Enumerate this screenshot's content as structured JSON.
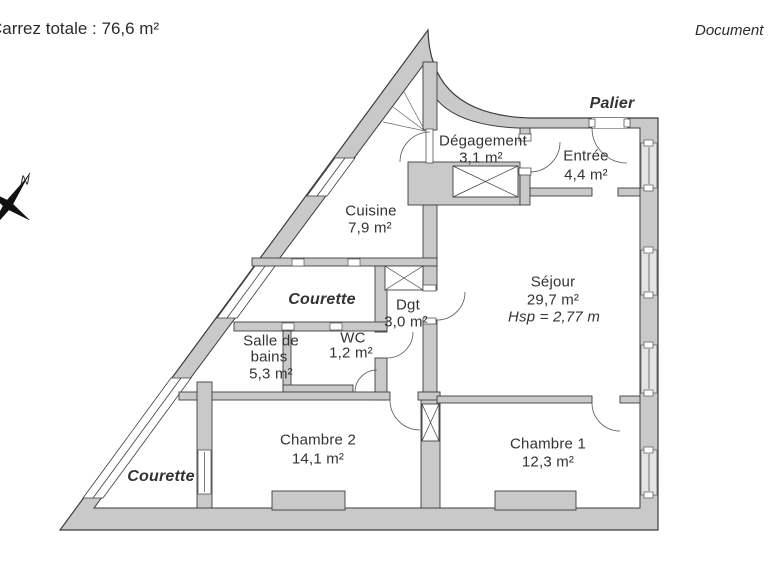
{
  "header": {
    "surface_note": "Carrez totale :  76,6 m²",
    "document_note": "Document n"
  },
  "plan": {
    "landing_label": "Palier",
    "compass_north": "N",
    "rooms": {
      "degagement": {
        "name": "Dégagement",
        "area": "3,1 m²"
      },
      "entree": {
        "name": "Entrée",
        "area": "4,4 m²"
      },
      "cuisine": {
        "name": "Cuisine",
        "area": "7,9 m²"
      },
      "sejour": {
        "name": "Séjour",
        "area": "29,7 m²",
        "ceiling_height": "Hsp = 2,77 m"
      },
      "courette_haut": {
        "name": "Courette"
      },
      "dgt": {
        "name": "Dgt",
        "area": "3,0 m²"
      },
      "wc": {
        "name": "WC",
        "area": "1,2 m²"
      },
      "salle_de_bains": {
        "name_line1": "Salle de",
        "name_line2": "bains",
        "area": "5,3 m²"
      },
      "chambre2": {
        "name": "Chambre 2",
        "area": "14,1 m²"
      },
      "chambre1": {
        "name": "Chambre 1",
        "area": "12,3 m²"
      },
      "courette_bas": {
        "name": "Courette"
      }
    }
  },
  "colors": {
    "wall_fill": "#c9c9c9",
    "wall_line": "#3d3d3d",
    "window_fill": "#e4e4e4",
    "text": "#333333"
  }
}
